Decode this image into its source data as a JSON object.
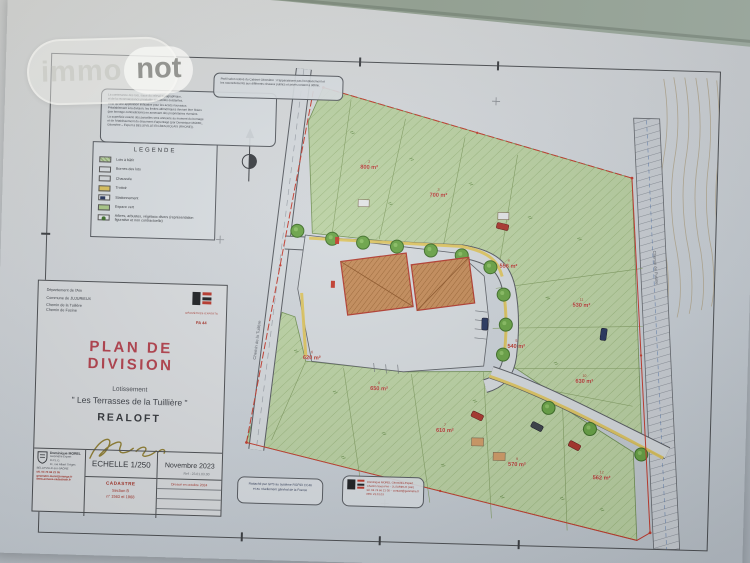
{
  "watermark": {
    "immo": "immo",
    "not": "not"
  },
  "colors": {
    "title_red": "#b2404c",
    "label_red": "#b5382b",
    "parcel_green": "#b9d0a2",
    "trottoir_yellow": "#dcc35c",
    "surface_green_gray": "#97a194"
  },
  "legend": {
    "title": "LEGENDE",
    "items": [
      {
        "swatch": "lots",
        "label": "Lots à bâtir"
      },
      {
        "swatch": "bornes",
        "label": "Bornes des lots"
      },
      {
        "swatch": "chaussee",
        "label": "Chaussée"
      },
      {
        "swatch": "trottoir",
        "label": "Trottoir"
      },
      {
        "swatch": "stationnement",
        "label": "Stationnement"
      },
      {
        "swatch": "espace-vert",
        "label": "Espace vert"
      },
      {
        "swatch": "arbres",
        "label": "Arbres, arbustes, végétaux divers (représentation figurative et non contractuelle)"
      }
    ]
  },
  "notes": {
    "top_left": [
      "La contenance des lots, issue du relevé topographique,",
      "et de la reconnaissance préalable des limites existantes,",
      "n'est qu'une application indicative pour les accès nouveaux.",
      "Préalablement à la division, les limites altimétriques devront être fixées",
      "(par bornage contradictoire) en annexant des propriétaires riverains.",
      "La superficie exacte des parcelles sera annexée au moment du bornage",
      "et de l'établissement du document d'arpentage (par Dominique MOREL,",
      "Géomètre – Expert à BELLEVILLE-EN-BEAUJOLAIS (RHONE))."
    ],
    "top_center": [
      "Profil selon relevé du Cabinet Géomètre : n'apparaissent pas l'emplacement et",
      "les raccordements aux différents réseaux publics et privés restant à définir."
    ],
    "bottom_left": [
      "Rattaché par GPS au système RGF93 CC46",
      "et au nivellement général de la France"
    ],
    "bottom_right": [
      "Dominique MOREL Géomètre-Expert",
      "Chemin Sous-Pré – JUJURIEUX (Ain)",
      "tél. 04 74 66 21 05 – contact@geometre.fr",
      "REF 23.01.03"
    ]
  },
  "title_block": {
    "department": "Département de l'Ain",
    "commune": "Commune de JUJURIEUX",
    "address_line1": "Chemin de la Tuilière",
    "address_line2": "Chemin de Fusine",
    "org_caption": "GÉOMÈTRES-EXPERTS",
    "org_ref": "PA 44",
    "main_title": "PLAN DE DIVISION",
    "subtitle1": "Lotissement",
    "subtitle2": "\" Les Terrasses de la Tuillière \"",
    "subtitle3": "REALOFT",
    "ref": "Ref : 23.01.03.00",
    "scale_label": "ECHELLE 1/250",
    "date_label": "Novembre 2023",
    "cadastre_title": "CADASTRE",
    "cadastre_line1": "Section B",
    "cadastre_line2": "n° 1563 et 1968",
    "revision_note": "Dressé en octobre 2024",
    "surveyor_name": "Dominique MOREL",
    "surveyor_lines": [
      "Géomètre Expert D.P.L.G.",
      "11, rue Albert Trèges",
      "BELLEVILLE-sur-SAÔNE"
    ],
    "surveyor_red_lines": [
      "tél. 04 74 66 21 05",
      "geometre.morel@orange.fr",
      "www.annexe-cadastrale.fr"
    ]
  },
  "map": {
    "road_label_left": "Chemin de la Tuilière",
    "road_label_right": "Chemin de Fusine",
    "lots": [
      {
        "num": "2",
        "area": "800 m²",
        "x": 320,
        "y": 103
      },
      {
        "num": "3",
        "area": "700 m²",
        "x": 390,
        "y": 129
      },
      {
        "num": "4",
        "area": "556 m²",
        "x": 462,
        "y": 198
      },
      {
        "num": "11",
        "area": "530 m²",
        "x": 536,
        "y": 235
      },
      {
        "num": "5",
        "area": "540 m²",
        "x": 472,
        "y": 278
      },
      {
        "num": "10",
        "area": "630 m²",
        "x": 541,
        "y": 311
      },
      {
        "num": "6",
        "area": "620 m²",
        "x": 268,
        "y": 295
      },
      {
        "num": "8",
        "area": "650 m²",
        "x": 336,
        "y": 324
      },
      {
        "num": "7",
        "area": "610 m²",
        "x": 403,
        "y": 364
      },
      {
        "num": "9",
        "area": "570 m²",
        "x": 476,
        "y": 396
      },
      {
        "num": "12",
        "area": "562 m²",
        "x": 561,
        "y": 407
      }
    ]
  }
}
